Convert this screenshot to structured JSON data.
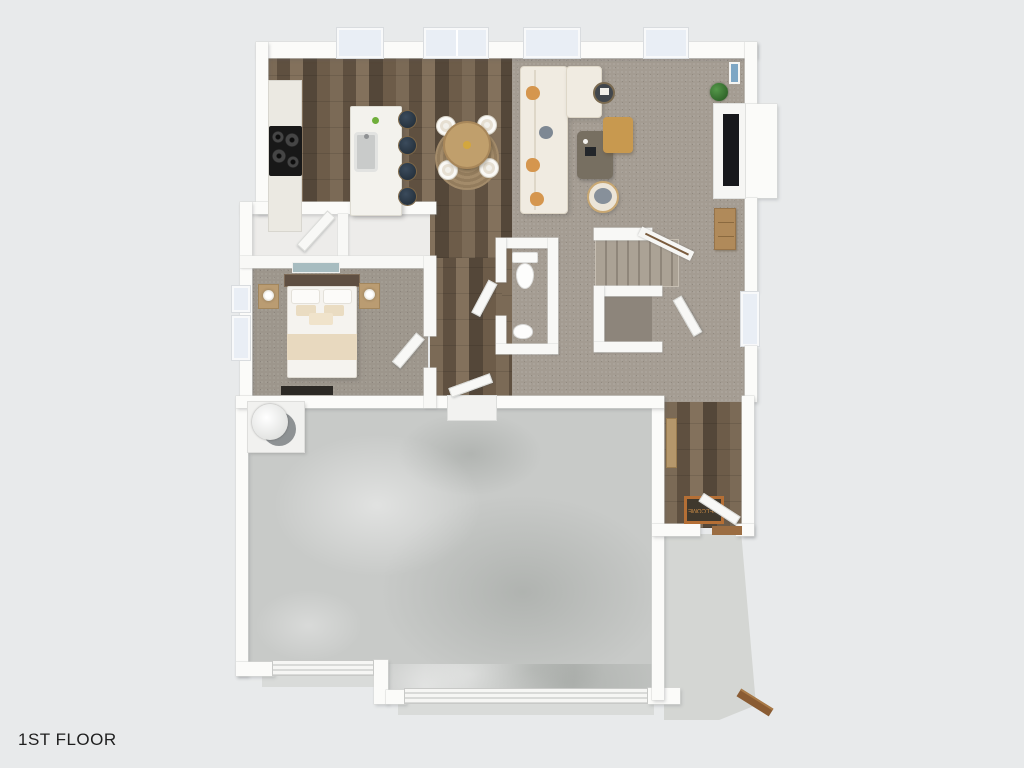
{
  "title": {
    "text": "1ST FLOOR"
  },
  "labels": {
    "welcome_mat": "WELCOME"
  },
  "palette": {
    "background": "#e8eaeb",
    "wall": "#fbfbf9",
    "wood_floor": "#6f5e4b",
    "carpet": "#a49c92",
    "bedroom_carpet": "#9a9287",
    "closet_carpet": "#8d857b",
    "concrete_garage": "#c8cac8",
    "concrete_porch": "#d4d6d3",
    "kitchen_island": "#f3f2ed",
    "counter": "#ebe9e2",
    "stove": "#1a1a1a",
    "bar_stool": "#2c3a47",
    "dining_table": "#c09f6c",
    "dining_rug": "#9d8567",
    "sofa": "#f0ebe1",
    "pillow_accent": "#d5964e",
    "pillow_gray": "#7e8893",
    "ottoman": "#c8994f",
    "coffee_table": "#776f61",
    "tv": "#17181c",
    "media_cabinet": "#b08a5a",
    "plant": "#3f7d3a",
    "bed_linen": "#f5f3ef",
    "bed_blanket": "#e8d9bf",
    "headboard": "#5f4f42",
    "nightstand": "#ba9c72",
    "welcome_mat": "#3f382d",
    "welcome_mat_border": "#b56f35",
    "wood_step": "#8a5c33",
    "window_glass": "#e9eef5"
  }
}
